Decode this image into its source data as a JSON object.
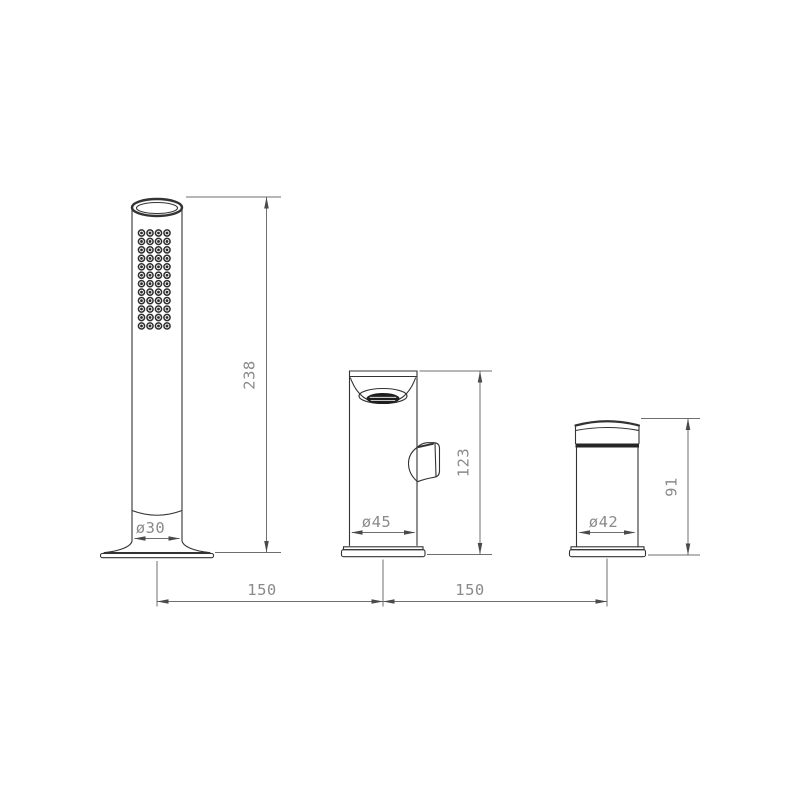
{
  "drawing": {
    "type": "technical-dimension-drawing",
    "subject": "3-hole deck mounted bath mixer set: hand shower, spout with diverter, control handle",
    "colors": {
      "background": "#ffffff",
      "outline": "#333333",
      "dimension_line": "#6f6f6f",
      "dimension_text": "#8a8a8a"
    },
    "hand_shower": {
      "height": "238",
      "diameter": "ø30"
    },
    "spout": {
      "height": "123",
      "diameter": "ø45"
    },
    "handle": {
      "height": "91",
      "diameter": "ø42"
    },
    "spacing": {
      "left": "150",
      "right": "150"
    }
  }
}
